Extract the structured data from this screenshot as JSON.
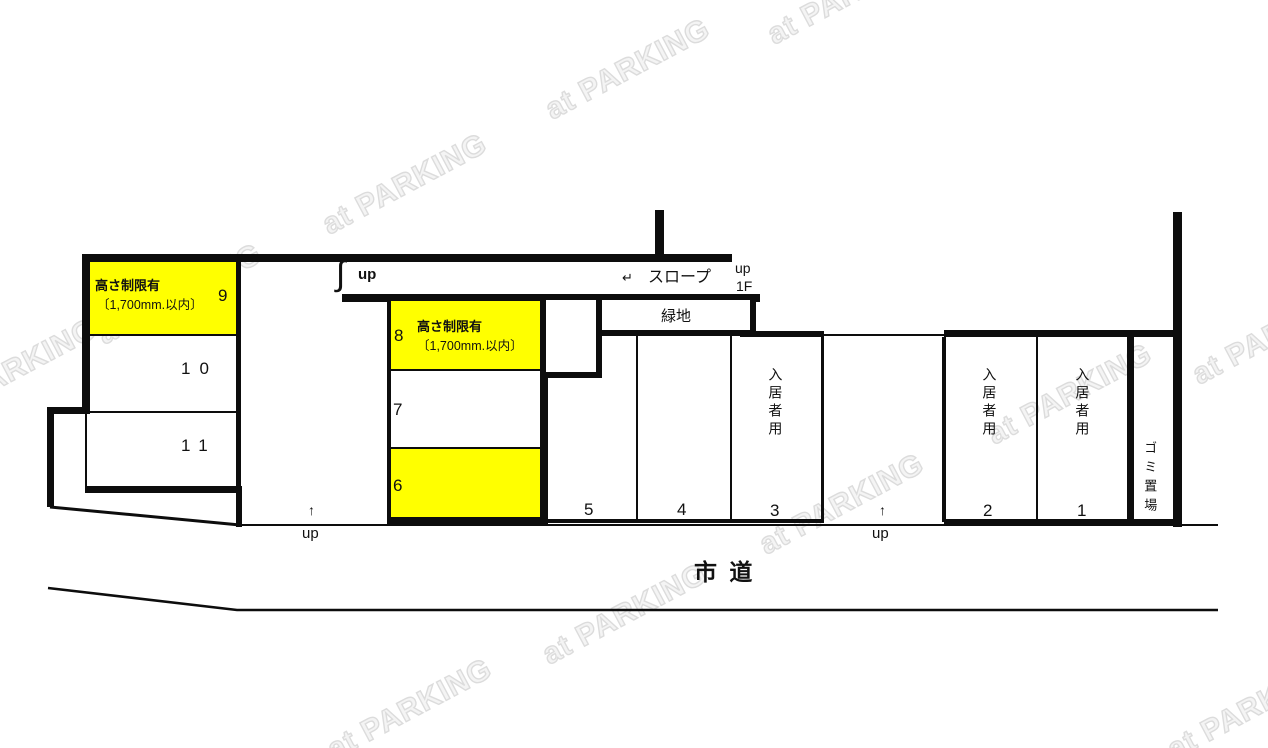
{
  "watermark": {
    "text": "at PARKING"
  },
  "restriction": {
    "line1": "高さ制限有",
    "line2": "〔1,700mm.以内〕"
  },
  "ramp": {
    "arrow": "↵",
    "label": "スロープ",
    "up": "up",
    "floor": "1F"
  },
  "stairs": {
    "symbol": "∫",
    "label": "up"
  },
  "driveways": {
    "arrow": "↑",
    "label": "up"
  },
  "areas": {
    "green": "緑地",
    "garbage": "ゴミ置場",
    "road": "市 道",
    "resident": "入居者用"
  },
  "spaces": {
    "n1": "1",
    "n2": "2",
    "n3": "3",
    "n4": "4",
    "n5": "5",
    "n6": "6",
    "n7": "7",
    "n8": "8",
    "n9": "9",
    "n10": "10",
    "n11": "11"
  },
  "colors": {
    "highlight": "#ffff00",
    "line": "#0d0d0d",
    "watermark": "#dcdcdc"
  }
}
